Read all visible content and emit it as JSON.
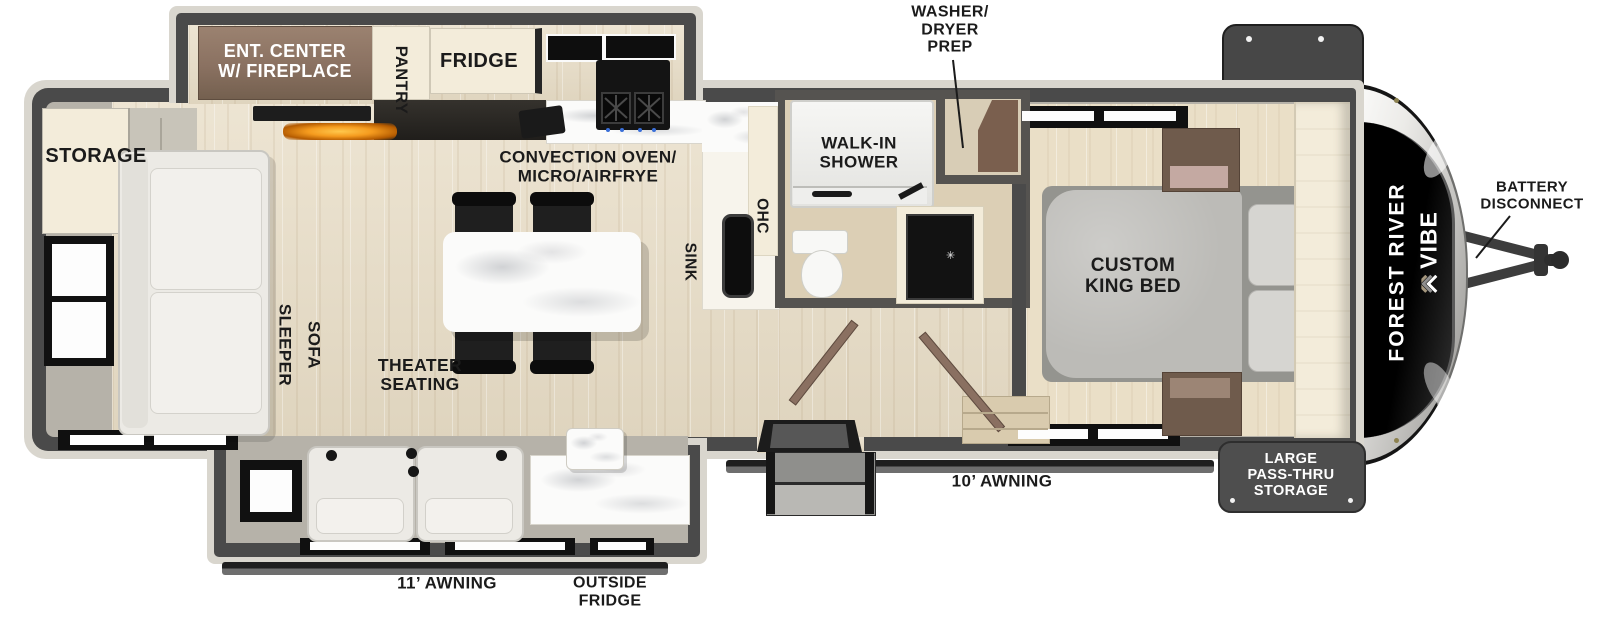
{
  "title": "Forest River Vibe travel trailer floor plan",
  "labels": {
    "washer_dryer_prep": [
      "WASHER/",
      "DRYER",
      "PREP"
    ],
    "battery_disconnect": [
      "BATTERY",
      "DISCONNECT"
    ],
    "storage": "STORAGE",
    "ent_center": [
      "ENT. CENTER",
      "W/ FIREPLACE"
    ],
    "pantry": "PANTRY",
    "fridge": "FRIDGE",
    "convection": [
      "CONVECTION OVEN/",
      "MICRO/AIRFRYE"
    ],
    "sink": "SINK",
    "ohc": "OHC",
    "walk_in_shower": [
      "WALK-IN",
      "SHOWER"
    ],
    "custom_king_bed": [
      "CUSTOM",
      "KING BED"
    ],
    "sleeper_sofa": [
      "SLEEPER",
      "SOFA"
    ],
    "theater_seating": [
      "THEATER",
      "SEATING"
    ],
    "awning_10": "10’ AWNING",
    "awning_11": "11’ AWNING",
    "outside_fridge": [
      "OUTSIDE",
      "FRIDGE"
    ],
    "pass_thru_storage": [
      "LARGE",
      "PASS-THRU",
      "STORAGE"
    ],
    "brand_forest_river": "FOREST RIVER",
    "brand_vibe": "VIBE"
  },
  "colors": {
    "wall": "#4a4a4a",
    "body_outline": "#d9d6ce",
    "interior_gray": "#b6b2a9",
    "wood_floor": "#e8ddc6",
    "bedroom_floor": "#eadfc7",
    "cabinet_cream": "#f3ecda",
    "cabinet_brown": "#8a7161",
    "bed_gray": "#bcbbb7",
    "seat_white": "#eceae5",
    "appliance_black": "#141414",
    "fireplace_glow": "#f59b1e",
    "label_ink": "#1b1b1b",
    "callout_dark": "#4e4e4e",
    "cap_black": "#0e0e0e"
  }
}
